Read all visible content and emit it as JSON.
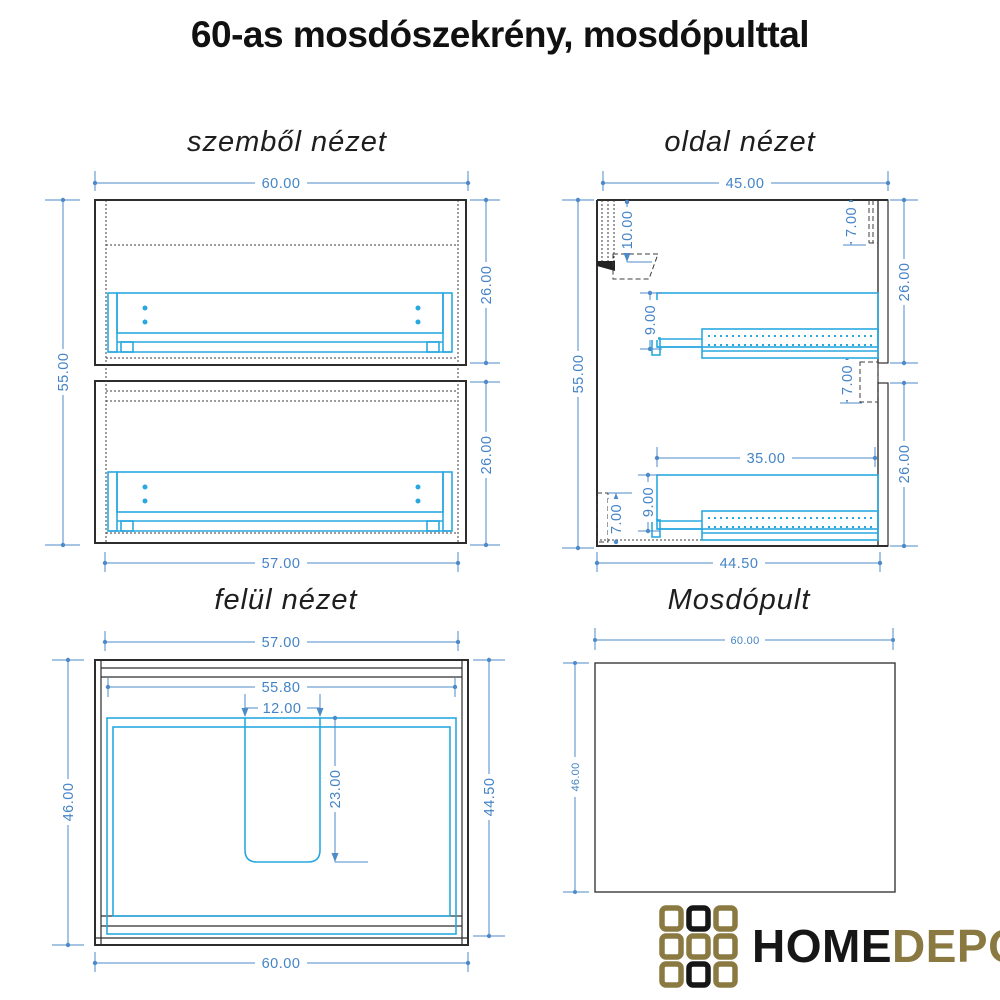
{
  "page": {
    "title": "60-as mosdószekrény, mosdópulttal"
  },
  "colors": {
    "dimension_blue": "#4484c6",
    "hardware_cyan": "#29a8e0",
    "line_black": "#2d2d2d",
    "logo_gold": "#8a7a42",
    "logo_black": "#161616"
  },
  "front": {
    "title": "szemből nézet",
    "dim_width_top": "60.00",
    "dim_height_left": "55.00",
    "dim_drawer_upper": "26.00",
    "dim_drawer_lower": "26.00",
    "dim_width_bottom": "57.00"
  },
  "side": {
    "title": "oldal nézet",
    "dim_depth_top": "45.00",
    "dim_height_left": "55.00",
    "dim_hanger_offset": "10.00",
    "dim_top_inset": "7.00",
    "dim_front_upper": "26.00",
    "dim_slide_upper": "9.00",
    "dim_mid_inset": "7.00",
    "dim_drawer_depth": "35.00",
    "dim_slide_lower": "9.00",
    "dim_bottom_inset": "7.00",
    "dim_front_lower": "26.00",
    "dim_depth_bottom": "44.50"
  },
  "top": {
    "title": "felül nézet",
    "dim_width_top": "57.00",
    "dim_inner_width": "55.80",
    "dim_cutout_width": "12.00",
    "dim_cutout_depth": "23.00",
    "dim_depth_left": "46.00",
    "dim_depth_right": "44.50",
    "dim_width_bottom": "60.00"
  },
  "counter": {
    "title": "Mosdópult",
    "dim_width_top": "60.00",
    "dim_depth_left": "46.00"
  },
  "logo": {
    "home": "HOME",
    "depo": "DEPO",
    "grid": [
      [
        "gold",
        "black",
        "gold"
      ],
      [
        "gold",
        "gold",
        "gold"
      ],
      [
        "gold",
        "black",
        "gold"
      ]
    ],
    "colors": {
      "gold": "#8a7a42",
      "black": "#161616"
    }
  }
}
